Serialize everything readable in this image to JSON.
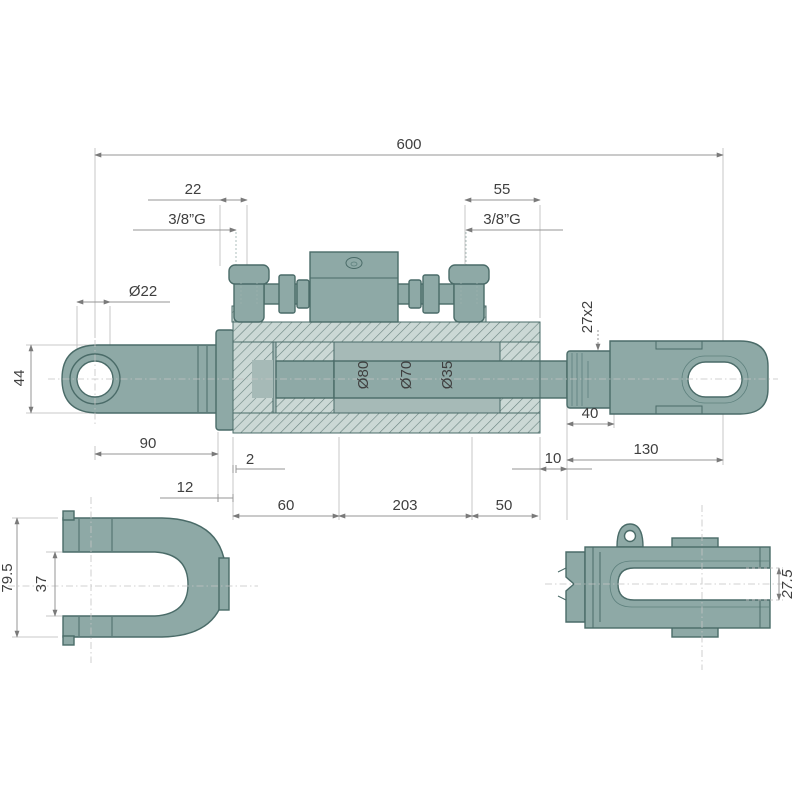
{
  "drawing": {
    "title": "Hydraulic piston top link — sectioned technical drawing with end views",
    "colors": {
      "part_fill": "#8EA9A6",
      "part_outline": "#4A6B68",
      "hatch_bg": "#CBD8D5",
      "hatch_line": "#6A8380",
      "chamber_fill": "#A6BAB7",
      "dim_line": "#969696",
      "text": "#3F3F3F",
      "background": "#FFFFFF"
    },
    "dims": {
      "overall_length": "600",
      "port_left_offset": "22",
      "port_left_thread": "3/8”G",
      "port_right_offset": "55",
      "port_right_thread": "3/8”G",
      "eye_hole_dia": "Ø22",
      "eye_height": "44",
      "rod_thread": "27x2",
      "eye_to_flange": "90",
      "gland_gap": "2",
      "flange_width": "12",
      "dia_bore": "Ø80",
      "dia_inner": "Ø70",
      "dia_rod": "Ø35",
      "thread_length": "40",
      "shoulder_length": "10",
      "fork_length": "130",
      "head_length": "60",
      "tube_length": "203",
      "tail_length": "50",
      "clevis_height": "79.5",
      "clevis_gap": "37",
      "fork_slot_width": "27.5"
    }
  }
}
